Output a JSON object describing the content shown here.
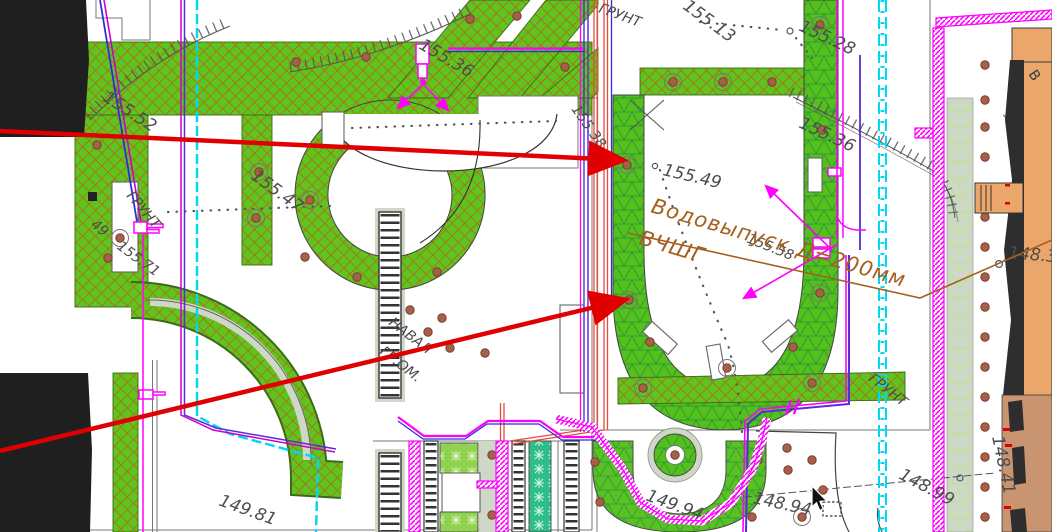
{
  "drawing": {
    "type": "landscape-site-plan",
    "language": "ru"
  },
  "labels": {
    "e15552": "155.52",
    "gruntLeft": "ГРУНТ",
    "gruntTop": "ГРУНТ",
    "gruntRight": "ГРУНТ",
    "e15536t": "155.36",
    "e15513": "155.13",
    "e15528": "155.28",
    "e15538": "155.38",
    "e15549": "155.49",
    "e15547": "155.47",
    "e15571": "155.71",
    "e49": "49",
    "e15536r": "155.36",
    "e15558": "155.58",
    "naval1": "НАВАЛ",
    "naval2": "ГР.ОМ.",
    "e14981": "149.81",
    "e14994": "149.94",
    "e14894": "148.94",
    "e14899": "148.99",
    "e14841": "148.41",
    "e1483": "148.3",
    "bldgV": "В"
  },
  "annotation": {
    "line1": "Водовыпуск Д=200мм",
    "line2": "ВЧШГ"
  },
  "colors": {
    "lawn_green": "#5ec41e",
    "hatch_red": "#c7531b",
    "hatch_dark_green": "#2f9b35",
    "sage": "#cfd8c8",
    "teal_planting": "#2fbd8a",
    "magenta_utility": "#ff00ff",
    "cyan_utility": "#00d9f2",
    "purple_utility": "#5a2bd8",
    "blue_utility": "#2f2fd8",
    "heat_red": "#e84b3c",
    "leader_red": "#e00000",
    "annotation_brown": "#a5601f",
    "tree_brown": "#a5604a",
    "building_orange": "#eba76b",
    "building_brown": "#c99470",
    "black_zone": "#1f1f1f"
  }
}
